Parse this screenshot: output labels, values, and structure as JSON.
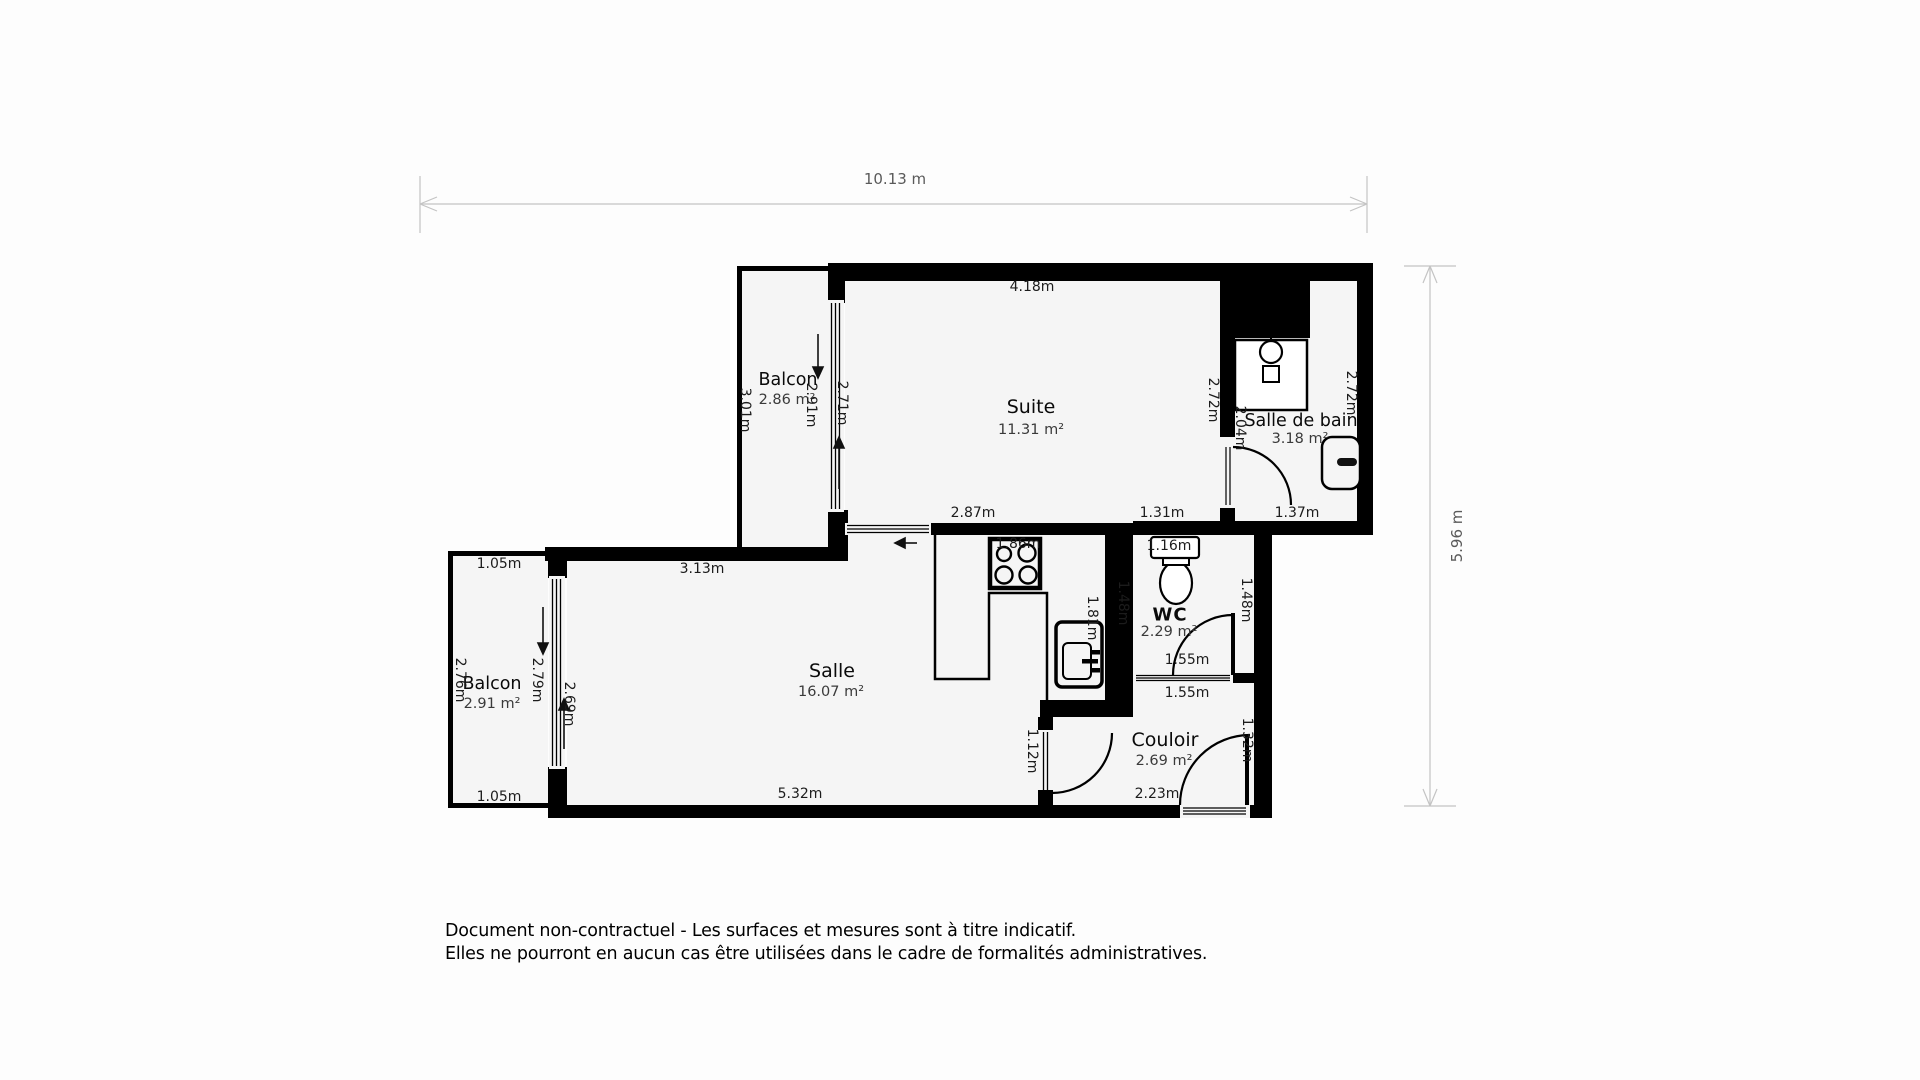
{
  "dims": {
    "total_width": "10.13 m",
    "total_height": "5.96 m",
    "suite_top": "4.18m",
    "suite_left": "2.71m",
    "suite_right": "2.72m",
    "suite_bottom_left": "2.87m",
    "suite_bottom_right": "1.31m",
    "balcon_top_left": "3.01m",
    "balcon_top_window": "2.91m",
    "sdb_door": "2.04m",
    "sdb_right": "2.72m",
    "sdb_bottom": "1.37m",
    "wc_top": "1.16m",
    "wc_left": "1.48m",
    "wc_right": "1.48m",
    "wc_bottom": "1.55m",
    "couloir_top": "1.55m",
    "kitchen_width": "1.86m",
    "kitchen_sink": "1.81m",
    "salle_top": "3.13m",
    "salle_bottom": "5.32m",
    "salle_window": "2.69m",
    "balcon_left_top": "1.05m",
    "balcon_left_bottom": "1.05m",
    "balcon_left_outer": "2.76m",
    "balcon_left_window": "2.79m",
    "salle_couloir_door": "1.12m",
    "couloir_bottom": "2.23m",
    "entrance_door": "1.32m"
  },
  "rooms": {
    "suite": {
      "name": "Suite",
      "area": "11.31 m²"
    },
    "salle_de_bain": {
      "name": "Salle de bain",
      "area": "3.18 m²"
    },
    "balcon_top": {
      "name": "Balcon",
      "area": "2.86 m²"
    },
    "balcon_left": {
      "name": "Balcon",
      "area": "2.91 m²"
    },
    "salle": {
      "name": "Salle",
      "area": "16.07 m²"
    },
    "wc": {
      "name": "WC",
      "area": "2.29 m²"
    },
    "couloir": {
      "name": "Couloir",
      "area": "2.69 m²"
    }
  },
  "disclaimer": {
    "line1": "Document non-contractuel - Les surfaces et mesures sont à titre indicatif.",
    "line2": "Elles ne pourront en aucun cas être utilisées dans le cadre de formalités administratives."
  },
  "colors": {
    "wall": "#000000",
    "room_fill": "#f5f5f5",
    "dimension_line": "#c4c4c4"
  }
}
